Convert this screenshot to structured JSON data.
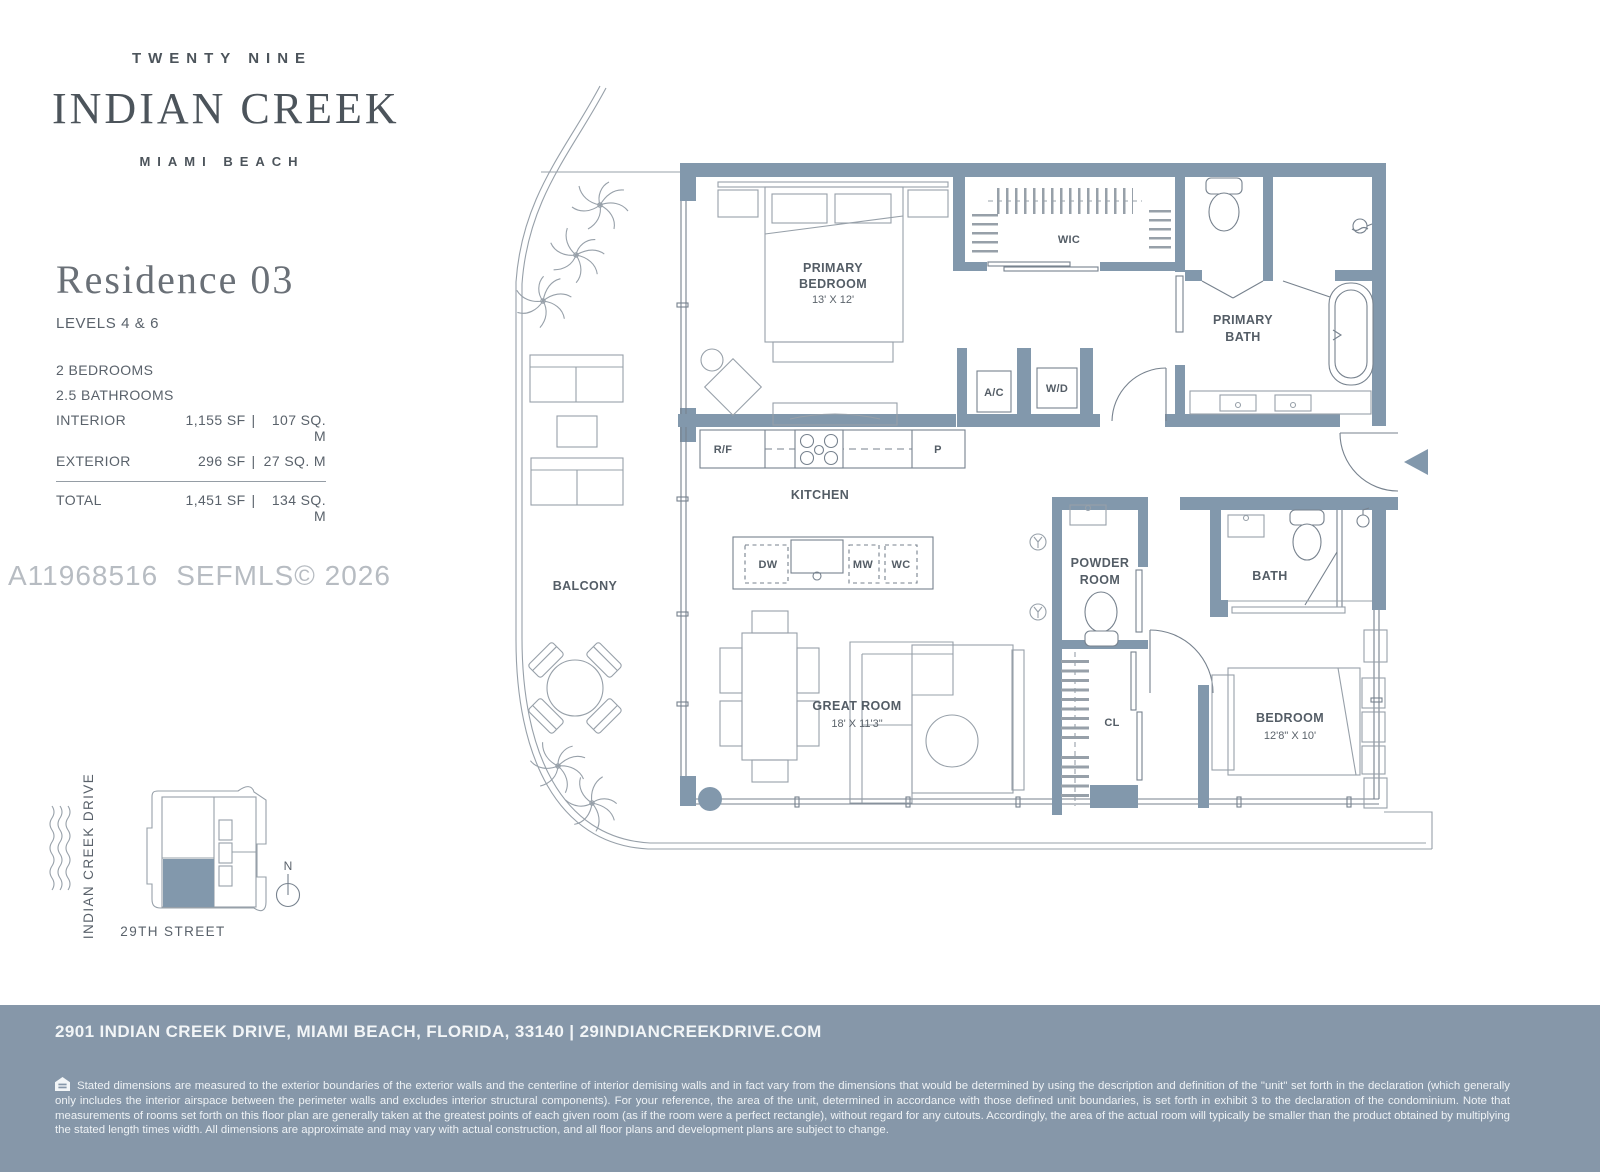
{
  "brand": {
    "line1": "TWENTY NINE",
    "line2": "INDIAN CREEK",
    "line3": "MIAMI BEACH"
  },
  "residence": {
    "title": "Residence 03",
    "levels": "LEVELS 4 & 6",
    "facts": [
      "2 BEDROOMS",
      "2.5 BATHROOMS"
    ],
    "areas": [
      {
        "label": "INTERIOR",
        "sf": "1,155 SF",
        "sep": "|",
        "sqm": "107 SQ. M"
      },
      {
        "label": "EXTERIOR",
        "sf": "296 SF",
        "sep": "|",
        "sqm": "27 SQ. M"
      }
    ],
    "total": {
      "label": "TOTAL",
      "sf": "1,451 SF",
      "sep": "|",
      "sqm": "134 SQ. M"
    }
  },
  "watermark": {
    "mls_id": "A11968516",
    "source": "SEFMLS© 2026"
  },
  "floorplan": {
    "rooms": {
      "primary_bedroom": {
        "l1": "PRIMARY",
        "l2": "BEDROOM",
        "dims": "13' X 12'"
      },
      "wic": "WIC",
      "primary_bath": {
        "l1": "PRIMARY",
        "l2": "BATH"
      },
      "ac": "A/C",
      "wd": "W/D",
      "rf": "R/F",
      "pantry": "P",
      "kitchen": "KITCHEN",
      "dw": "DW",
      "mw": "MW",
      "wc": "WC",
      "balcony": "BALCONY",
      "powder": {
        "l1": "POWDER",
        "l2": "ROOM"
      },
      "bath": "BATH",
      "cl": "CL",
      "great_room": {
        "l1": "GREAT ROOM",
        "dims": "18' X 11'3\""
      },
      "bedroom": {
        "l1": "BEDROOM",
        "dims": "12'8\" X 10'"
      }
    }
  },
  "siteplan": {
    "drive": "INDIAN CREEK DRIVE",
    "street": "29TH STREET",
    "north": "N"
  },
  "footer": {
    "address": "2901 INDIAN CREEK DRIVE, MIAMI BEACH, FLORIDA, 33140 | 29INDIANCREEKDRIVE.COM",
    "disclaimer": "Stated dimensions are measured to the exterior boundaries of the exterior walls and the centerline of interior demising walls and in fact vary from the dimensions that would be determined by using the description and definition of the \"unit\" set forth in the declaration (which generally only includes the interior airspace between the perimeter walls and excludes interior structural components). For your reference, the area of the unit, determined in accordance with those defined unit boundaries, is set forth in exhibit 3 to the declaration of the condominium. Note that measurements of rooms set forth on this floor plan are generally taken at the greatest points of each given room (as if the room were a perfect rectangle), without regard for any cutouts. Accordingly, the area of the actual room will typically be smaller than the product obtained by multiplying the stated length times width. All dimensions are approximate and may vary with actual construction, and all floor plans and development plans are subject to change."
  },
  "colors": {
    "wall": "#8298AC",
    "footer_bg": "#8697A9",
    "watermark": "#B7BCC2"
  }
}
